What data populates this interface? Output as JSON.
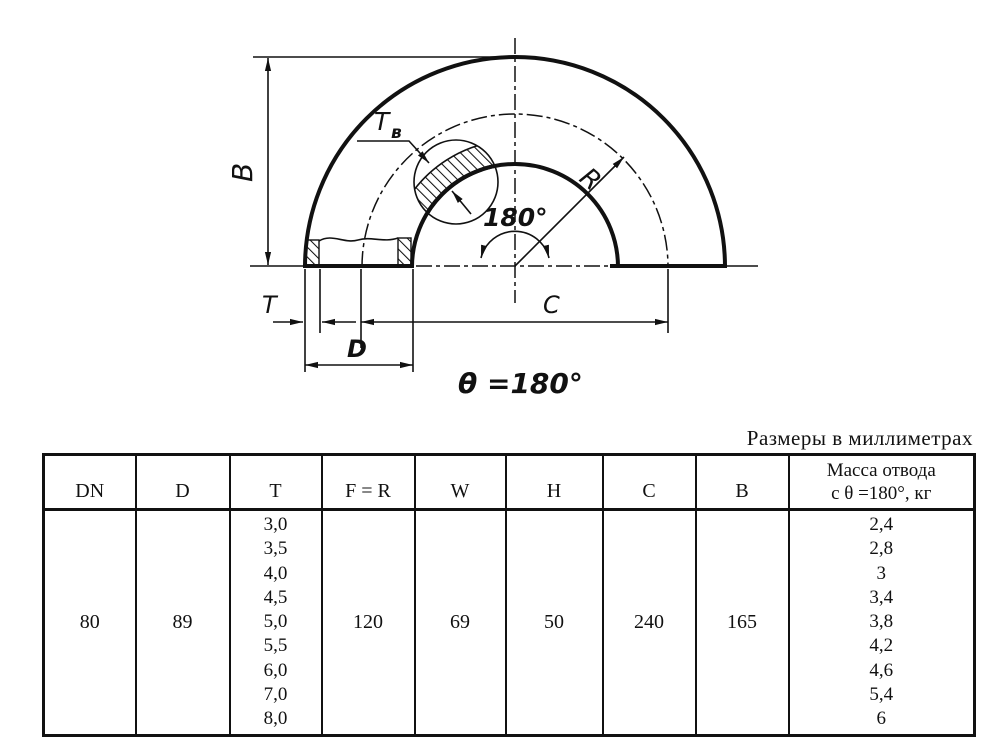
{
  "caption": "Размеры в миллиметрах",
  "drawing": {
    "labels": {
      "b_dim": "B",
      "tv_main": "T",
      "tv_sub": "в",
      "radius": "R",
      "angle_arc": "180°",
      "t_dim": "T",
      "d_dim": "D",
      "c_dim": "C",
      "theta_note": "θ =180°"
    }
  },
  "table": {
    "headers": [
      "DN",
      "D",
      "T",
      "F = R",
      "W",
      "H",
      "C",
      "B"
    ],
    "mass_header": {
      "line1": "Масса отвода",
      "line2": "с θ =180°, кг"
    },
    "row": {
      "dn": "80",
      "d": "89",
      "t_values": [
        "3,0",
        "3,5",
        "4,0",
        "4,5",
        "5,0",
        "5,5",
        "6,0",
        "7,0",
        "8,0"
      ],
      "f_r": "120",
      "w": "69",
      "h": "50",
      "c": "240",
      "b": "165",
      "mass_values": [
        "2,4",
        "2,8",
        "3",
        "3,4",
        "3,8",
        "4,2",
        "4,6",
        "5,4",
        "6"
      ]
    }
  },
  "colors": {
    "ink": "#111111",
    "background": "#ffffff"
  }
}
